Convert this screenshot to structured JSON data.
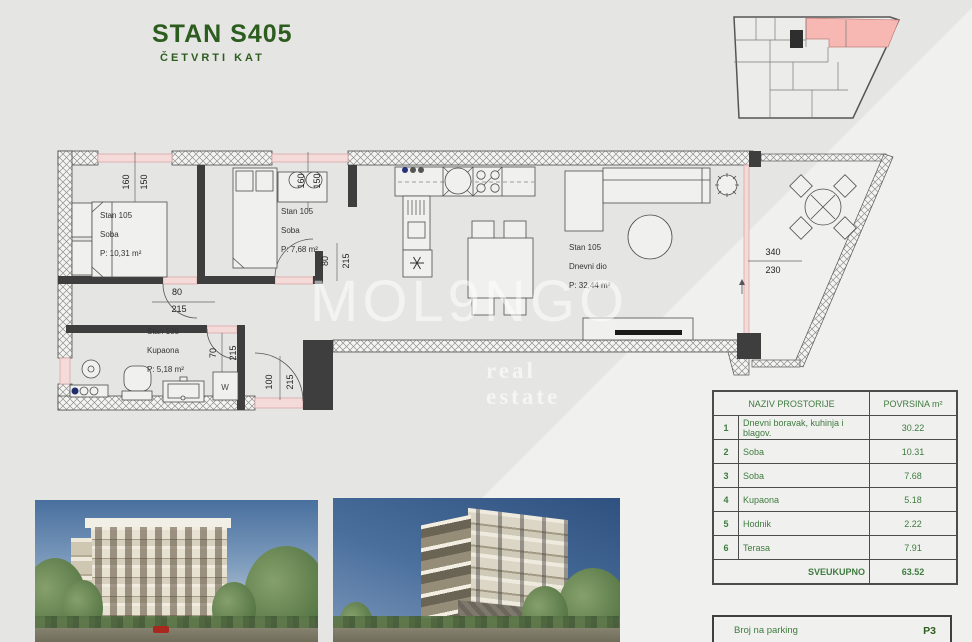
{
  "header": {
    "title": "STAN S405",
    "subtitle": "ČETVRTI KAT",
    "title_color": "#2d5c1f"
  },
  "watermark": {
    "line1": "MOL9NGO",
    "line2": "real estate"
  },
  "key_plan": {
    "highlight_color": "#f7b7b3"
  },
  "plan": {
    "rooms": [
      {
        "unit": "Stan 105",
        "name": "Soba",
        "area": "P: 10,31 m²"
      },
      {
        "unit": "Stan 105",
        "name": "Soba",
        "area": "P: 7,68 m²"
      },
      {
        "unit": "Stan 105",
        "name": "Dnevni dio",
        "area": "P: 32,44 m²"
      },
      {
        "unit": "Stan 105",
        "name": "Kupaona",
        "area": "P: 5,18 m²"
      }
    ],
    "dims": {
      "bed1_window": [
        "160",
        "150"
      ],
      "bed2_window": [
        "160",
        "150"
      ],
      "bed1_door": [
        "80",
        "215"
      ],
      "bed2_door": [
        "80",
        "215"
      ],
      "bath_door": [
        "70",
        "215"
      ],
      "entry_door": [
        "100",
        "215"
      ],
      "terrace": [
        "340",
        "230"
      ]
    },
    "fixtures": {
      "washer": "W"
    }
  },
  "table": {
    "header": {
      "name": "NAZIV PROSTORIJE",
      "area": "POVRSINA m²"
    },
    "rows": [
      {
        "num": "1",
        "name": "Dnevni boravak, kuhinja i blagov.",
        "area": "30.22"
      },
      {
        "num": "2",
        "name": "Soba",
        "area": "10.31"
      },
      {
        "num": "3",
        "name": "Soba",
        "area": "7.68"
      },
      {
        "num": "4",
        "name": "Kupaona",
        "area": "5.18"
      },
      {
        "num": "5",
        "name": "Hodnik",
        "area": "2.22"
      },
      {
        "num": "6",
        "name": "Terasa",
        "area": "7.91"
      }
    ],
    "total": {
      "label": "SVEUKUPNO",
      "value": "63.52"
    }
  },
  "parking": {
    "label": "Broj na parking",
    "value": "P3"
  }
}
